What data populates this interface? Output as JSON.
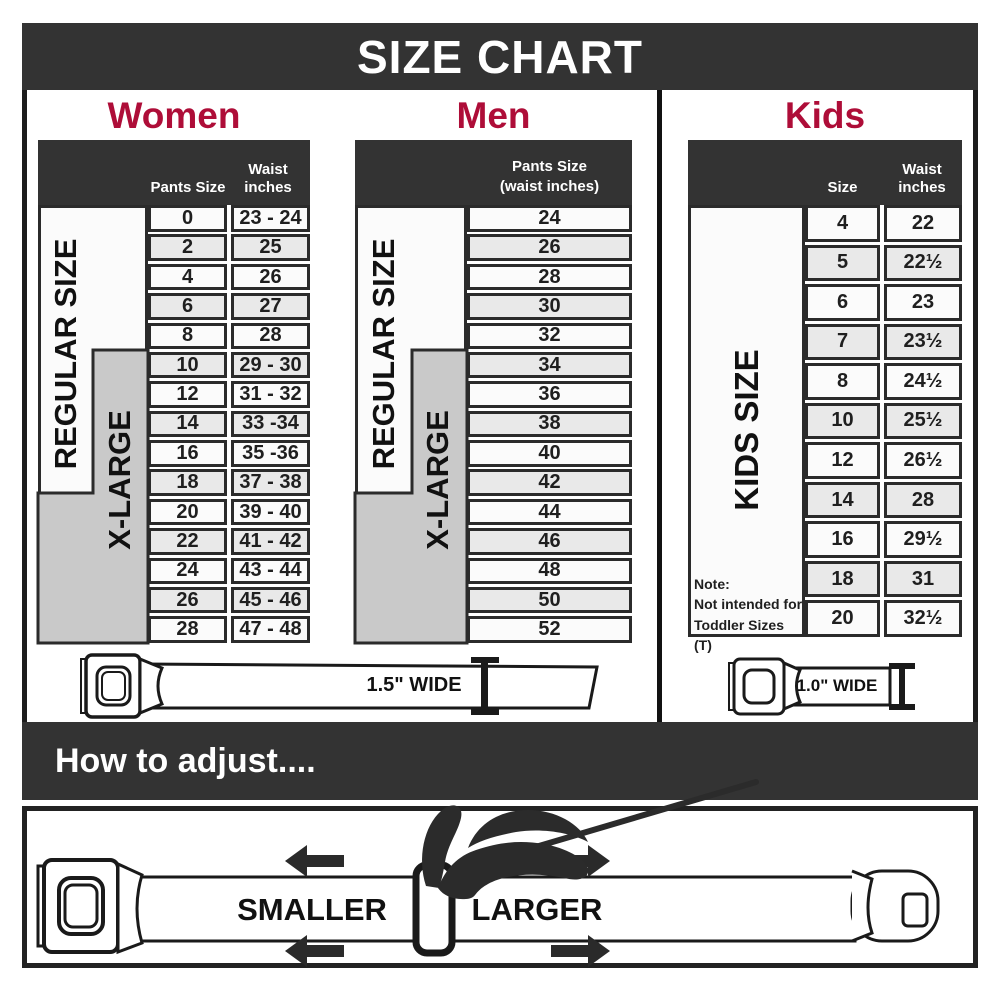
{
  "title": "SIZE CHART",
  "colors": {
    "dark": "#333333",
    "red": "#ae0d38",
    "gray": "#c9c9c9",
    "row_light": "#fbfbfb",
    "row_shaded": "#e9e9e9"
  },
  "women": {
    "heading": "Women",
    "col_pants": "Pants Size",
    "col_waist": "Waist inches",
    "regular_label": "REGULAR SIZE",
    "xlarge_label": "X-LARGE",
    "rows": [
      {
        "size": "0",
        "waist": "23 - 24"
      },
      {
        "size": "2",
        "waist": "25"
      },
      {
        "size": "4",
        "waist": "26"
      },
      {
        "size": "6",
        "waist": "27"
      },
      {
        "size": "8",
        "waist": "28"
      },
      {
        "size": "10",
        "waist": "29 - 30"
      },
      {
        "size": "12",
        "waist": "31 - 32"
      },
      {
        "size": "14",
        "waist": "33 -34"
      },
      {
        "size": "16",
        "waist": "35 -36"
      },
      {
        "size": "18",
        "waist": "37 - 38"
      },
      {
        "size": "20",
        "waist": "39 - 40"
      },
      {
        "size": "22",
        "waist": "41 - 42"
      },
      {
        "size": "24",
        "waist": "43 - 44"
      },
      {
        "size": "26",
        "waist": "45 - 46"
      },
      {
        "size": "28",
        "waist": "47 - 48"
      }
    ]
  },
  "men": {
    "heading": "Men",
    "col_line1": "Pants Size",
    "col_line2": "(waist inches)",
    "regular_label": "REGULAR SIZE",
    "xlarge_label": "X-LARGE",
    "rows": [
      {
        "size": "24"
      },
      {
        "size": "26"
      },
      {
        "size": "28"
      },
      {
        "size": "30"
      },
      {
        "size": "32"
      },
      {
        "size": "34"
      },
      {
        "size": "36"
      },
      {
        "size": "38"
      },
      {
        "size": "40"
      },
      {
        "size": "42"
      },
      {
        "size": "44"
      },
      {
        "size": "46"
      },
      {
        "size": "48"
      },
      {
        "size": "50"
      },
      {
        "size": "52"
      }
    ]
  },
  "kids": {
    "heading": "Kids",
    "col_size": "Size",
    "col_waist": "Waist inches",
    "label": "KIDS SIZE",
    "note_line1": "Note:",
    "note_line2": "Not intended for",
    "note_line3": "Toddler Sizes (T)",
    "rows": [
      {
        "size": "4",
        "waist": "22"
      },
      {
        "size": "5",
        "waist": "22½"
      },
      {
        "size": "6",
        "waist": "23"
      },
      {
        "size": "7",
        "waist": "23½"
      },
      {
        "size": "8",
        "waist": "24½"
      },
      {
        "size": "10",
        "waist": "25½"
      },
      {
        "size": "12",
        "waist": "26½"
      },
      {
        "size": "14",
        "waist": "28"
      },
      {
        "size": "16",
        "waist": "29½"
      },
      {
        "size": "18",
        "waist": "31"
      },
      {
        "size": "20",
        "waist": "32½"
      }
    ]
  },
  "belts": {
    "adult_width_label": "1.5\" WIDE",
    "kids_width_label": "1.0\" WIDE"
  },
  "adjust": {
    "bar_label": "How to adjust....",
    "smaller_label": "SMALLER",
    "larger_label": "LARGER"
  }
}
